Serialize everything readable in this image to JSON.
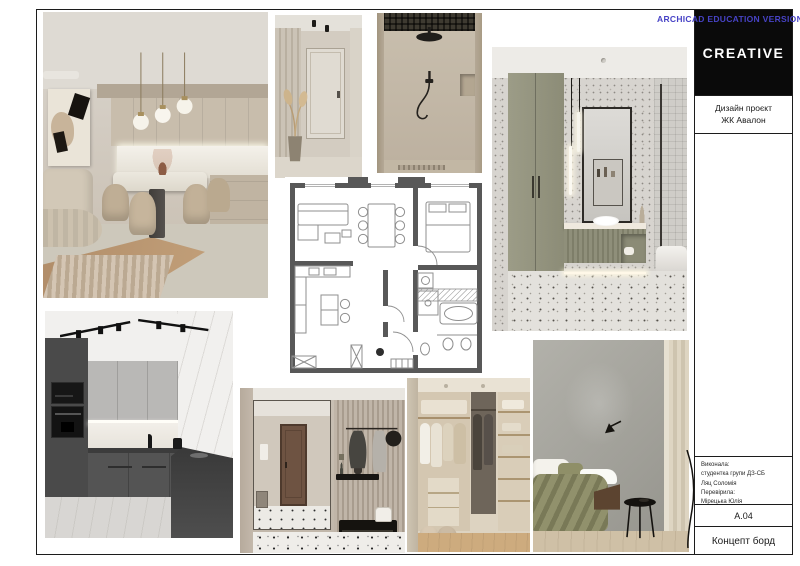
{
  "watermark": "ARCHICAD EDUCATION VERSION",
  "title_block": {
    "logo_text": "CREATIVE",
    "project_line1": "Дизайн проєкт",
    "project_line2": "ЖК Авалон",
    "credits": [
      "Виконала:",
      "студентка групи ДЗ-СБ",
      "Ляц Соломія",
      "Перевірила:",
      "Мірецька Юлія"
    ],
    "sheet_number": "A.04",
    "sheet_title": "Концепт борд"
  },
  "board": {
    "photos": [
      {
        "id": "living-dining",
        "label": "living-dining-room-render"
      },
      {
        "id": "hallway",
        "label": "hallway-render"
      },
      {
        "id": "shower",
        "label": "shower-room-render"
      },
      {
        "id": "bathroom",
        "label": "bathroom-render"
      },
      {
        "id": "floor-plan",
        "label": "apartment-floor-plan"
      },
      {
        "id": "kitchen",
        "label": "grey-kitchen-render"
      },
      {
        "id": "entryway",
        "label": "entryway-render"
      },
      {
        "id": "wardrobe",
        "label": "walk-in-wardrobe-render"
      },
      {
        "id": "bedroom",
        "label": "bedroom-render"
      }
    ]
  },
  "colors": {
    "watermark_blue": "#4743c6",
    "logo_background": "#0a0a0a",
    "plan_walls": "#585858",
    "sage_green": "#90907b",
    "olive_bedding": "#8a8a63",
    "beige": "#c9bfb1",
    "dark_kitchen_grey": "#4f4f4f"
  }
}
